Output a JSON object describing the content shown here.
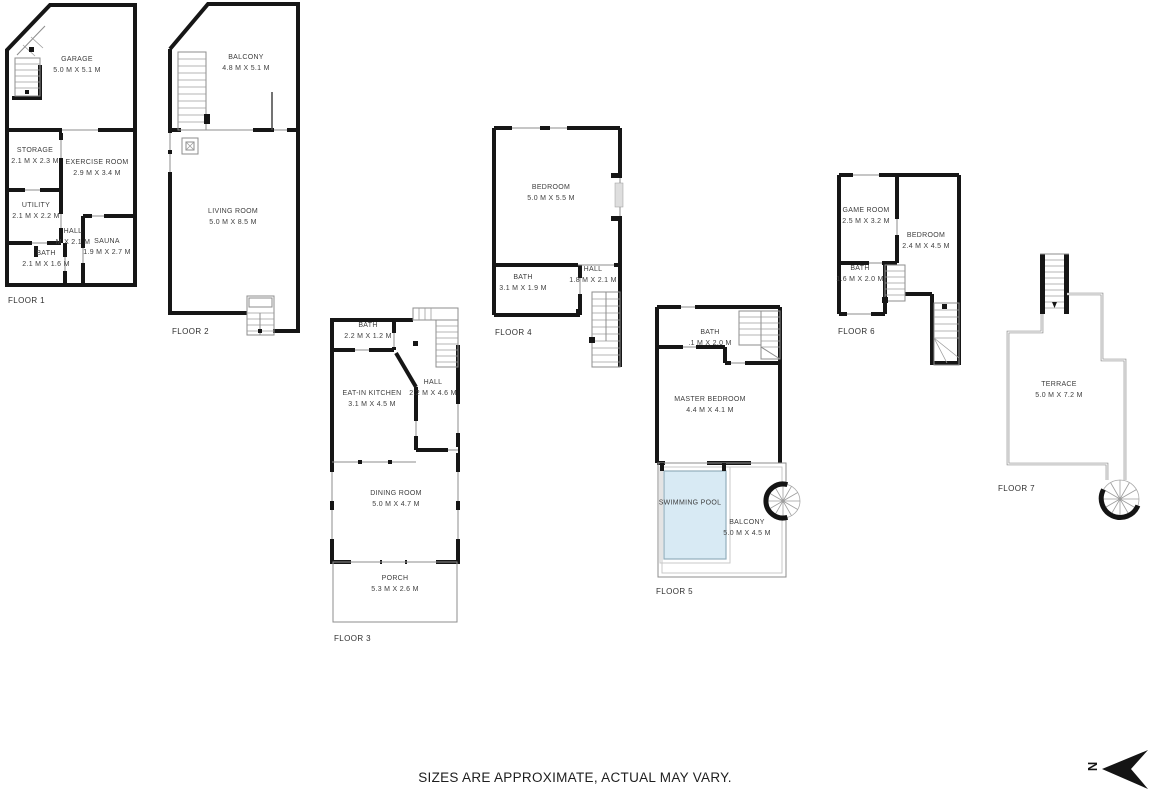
{
  "disclaimer": "SIZES ARE APPROXIMATE, ACTUAL MAY VARY.",
  "north": {
    "label": "N"
  },
  "colors": {
    "wall": "#161616",
    "pool_fill": "#d8eaf4",
    "background": "#ffffff"
  },
  "floors": [
    {
      "label": "FLOOR 1",
      "rooms": [
        {
          "name": "GARAGE",
          "dims": "5.0 M X 5.1 M"
        },
        {
          "name": "STORAGE",
          "dims": "2.1 M X 2.3 M"
        },
        {
          "name": "EXERCISE ROOM",
          "dims": "2.9 M X 3.4 M"
        },
        {
          "name": "UTILITY",
          "dims": "2.1 M X 2.2 M"
        },
        {
          "name": "HALL",
          "dims": "M X 2.1 M"
        },
        {
          "name": "SAUNA",
          "dims": "1.9 M X 2.7 M"
        },
        {
          "name": "BATH",
          "dims": "2.1 M X 1.6 M"
        }
      ]
    },
    {
      "label": "FLOOR 2",
      "rooms": [
        {
          "name": "BALCONY",
          "dims": "4.8 M X 5.1 M"
        },
        {
          "name": "LIVING ROOM",
          "dims": "5.0 M X 8.5 M"
        }
      ]
    },
    {
      "label": "FLOOR 3",
      "rooms": [
        {
          "name": "BATH",
          "dims": "2.2 M X 1.2 M"
        },
        {
          "name": "HALL",
          "dims": "2.2 M X 4.6 M"
        },
        {
          "name": "EAT-IN KITCHEN",
          "dims": "3.1 M X 4.5 M"
        },
        {
          "name": "DINING ROOM",
          "dims": "5.0 M X 4.7 M"
        },
        {
          "name": "PORCH",
          "dims": "5.3 M X 2.6 M"
        }
      ]
    },
    {
      "label": "FLOOR 4",
      "rooms": [
        {
          "name": "BEDROOM",
          "dims": "5.0 M X 5.5 M"
        },
        {
          "name": "BATH",
          "dims": "3.1 M X 1.9 M"
        },
        {
          "name": "HALL",
          "dims": "1.8 M X 2.1 M"
        }
      ]
    },
    {
      "label": "FLOOR 5",
      "rooms": [
        {
          "name": "BATH",
          "dims": ".1 M X 2.0 M"
        },
        {
          "name": "MASTER BEDROOM",
          "dims": "4.4 M X 4.1 M"
        },
        {
          "name": "SWIMMING POOL"
        },
        {
          "name": "BALCONY",
          "dims": "5.0 M X 4.5 M"
        }
      ]
    },
    {
      "label": "FLOOR 6",
      "rooms": [
        {
          "name": "GAME ROOM",
          "dims": "2.5 M X 3.2 M"
        },
        {
          "name": "BEDROOM",
          "dims": "2.4 M X 4.5 M"
        },
        {
          "name": "BATH",
          "dims": "1.6 M X 2.0 M"
        }
      ]
    },
    {
      "label": "FLOOR 7",
      "rooms": [
        {
          "name": "TERRACE",
          "dims": "5.0 M X 7.2 M"
        }
      ]
    }
  ]
}
